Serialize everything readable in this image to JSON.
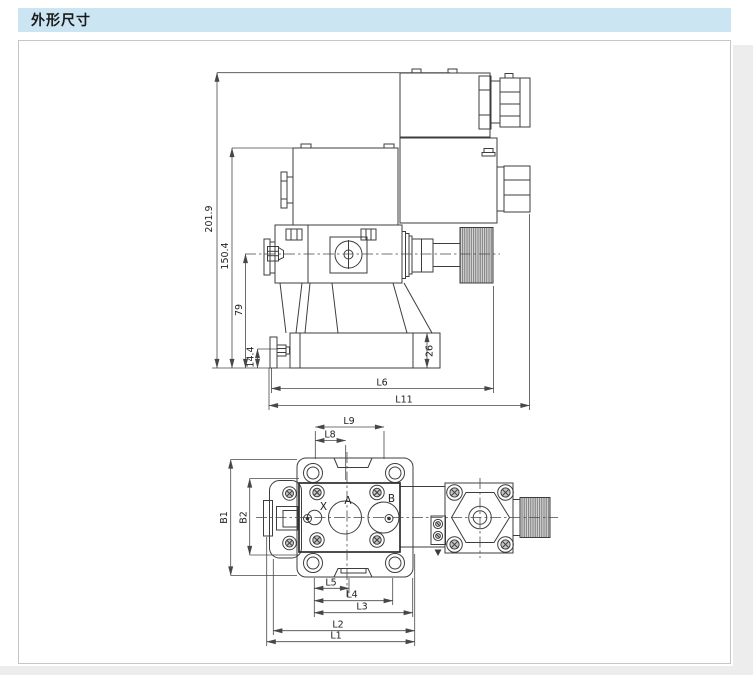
{
  "header": {
    "title": "外形尺寸"
  },
  "colors": {
    "header_bg": "#cbe5f3",
    "panel_border": "#c6c6c6",
    "line": "#3d3d3d"
  },
  "side_view": {
    "dims": {
      "total_height": "201.9",
      "solenoid_height": "150.4",
      "centerline_height": "79",
      "foot_height": "14.4",
      "base_thickness": "26",
      "l6": "L6",
      "l11": "L11"
    }
  },
  "top_view": {
    "dims": {
      "l9": "L9",
      "l8": "L8",
      "b1": "B1",
      "b2": "B2",
      "l5": "L5",
      "l4": "L4",
      "l3": "L3",
      "l2": "L2",
      "l1": "L1"
    },
    "ports": {
      "x": "X",
      "a": "A",
      "b": "B"
    }
  }
}
